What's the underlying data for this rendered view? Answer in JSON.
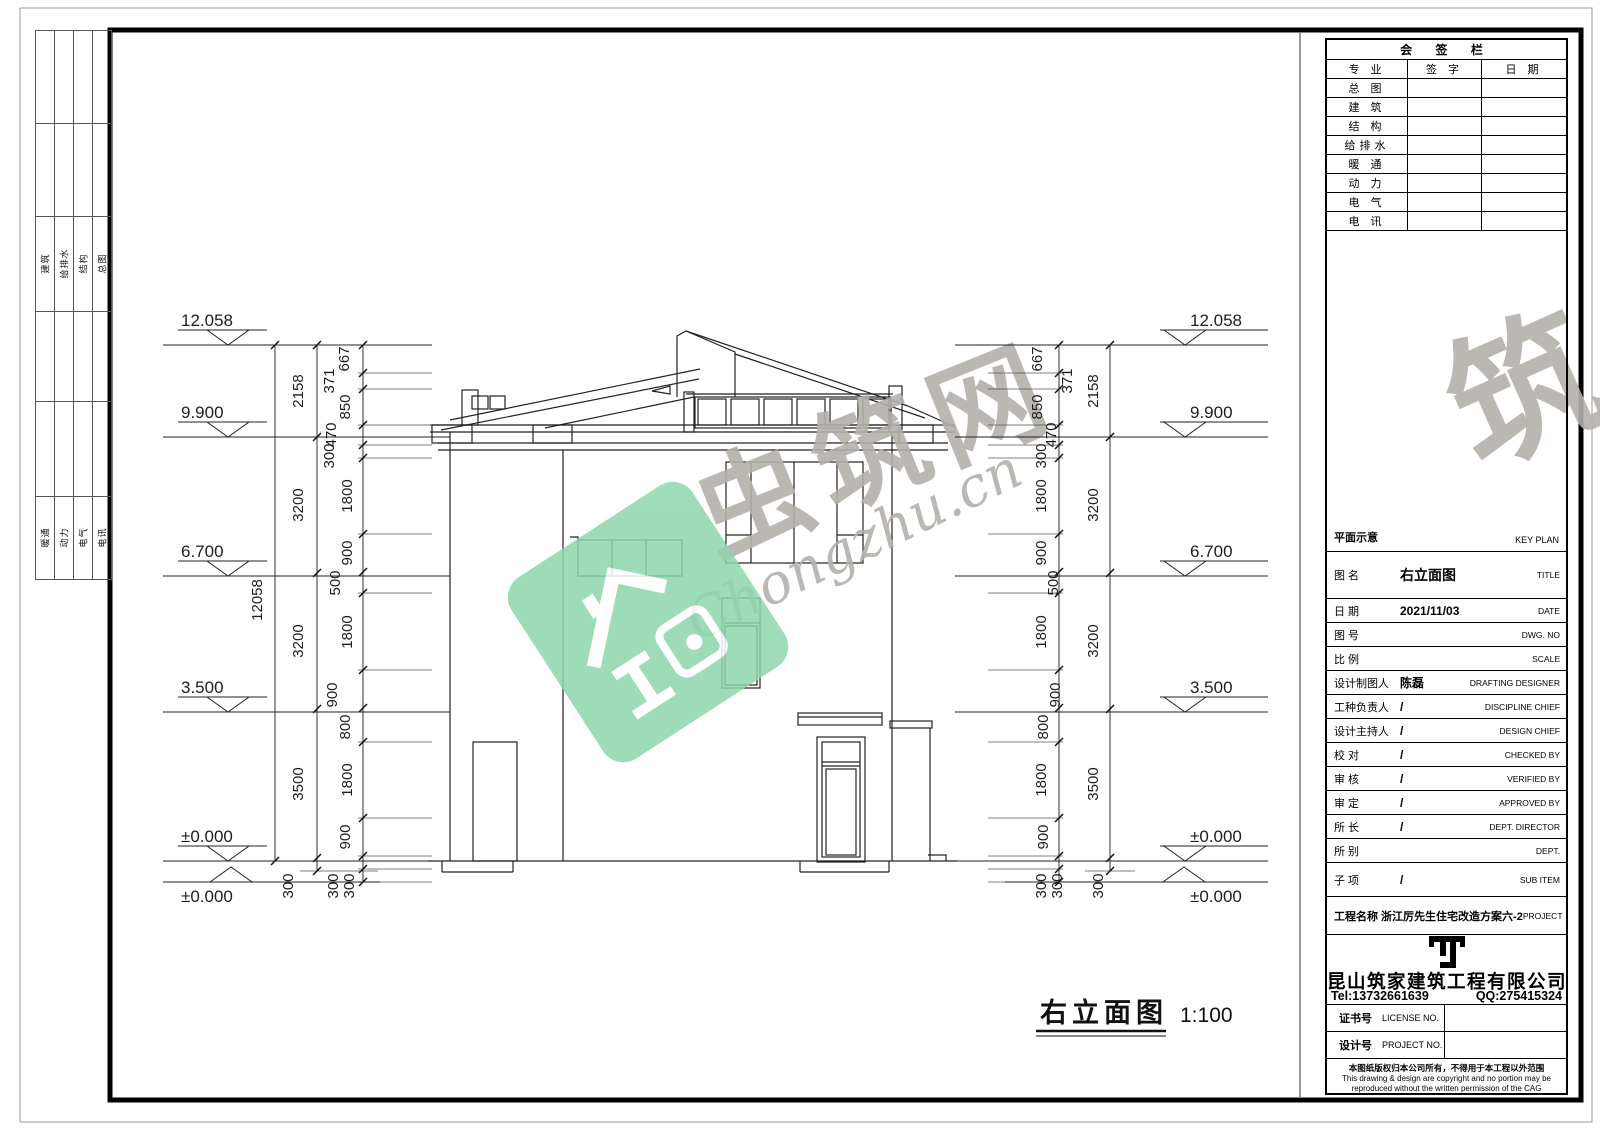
{
  "binding_strip": {
    "row1": [
      "建筑",
      "给排水",
      "结构",
      "总图"
    ],
    "row2": [
      "暖通",
      "动力",
      "电气",
      "电讯"
    ]
  },
  "signature_bar": {
    "title": "会 签 栏",
    "col_headers": [
      "专 业",
      "签 字",
      "日 期"
    ],
    "disciplines": [
      "总 图",
      "建 筑",
      "结 构",
      "给排水",
      "暖 通",
      "动 力",
      "电 气",
      "电 讯"
    ]
  },
  "key_plan": {
    "cn": "平面示意",
    "en": "KEY PLAN"
  },
  "title_block": {
    "rows": [
      {
        "cn": "图 名",
        "value": "右立面图",
        "en": "TITLE"
      },
      {
        "cn": "日 期",
        "value": "2021/11/03",
        "en": "DATE"
      },
      {
        "cn": "图 号",
        "value": "",
        "en": "DWG. NO"
      },
      {
        "cn": "比 例",
        "value": "",
        "en": "SCALE"
      },
      {
        "cn": "设计制图人",
        "value": "陈磊",
        "en": "DRAFTING DESIGNER"
      },
      {
        "cn": "工种负责人",
        "value": "/",
        "en": "DISCIPLINE CHIEF"
      },
      {
        "cn": "设计主持人",
        "value": "/",
        "en": "DESIGN CHIEF"
      },
      {
        "cn": "校 对",
        "value": "/",
        "en": "CHECKED BY"
      },
      {
        "cn": "审 核",
        "value": "/",
        "en": "VERIFIED BY"
      },
      {
        "cn": "审 定",
        "value": "/",
        "en": "APPROVED BY"
      },
      {
        "cn": "所 长",
        "value": "/",
        "en": "DEPT. DIRECTOR"
      },
      {
        "cn": "所 别",
        "value": "",
        "en": "DEPT."
      },
      {
        "cn": "子 项",
        "value": "/",
        "en": "SUB ITEM"
      }
    ],
    "project": {
      "cn": "工程名称 浙江厉先生住宅改造方案六-2",
      "en": "PROJECT"
    }
  },
  "company": {
    "name": "昆山筑家建筑工程有限公司",
    "tel": "Tel:13732661639",
    "qq": "QQ:275415324",
    "license_cn": "证书号",
    "license_en": "LICENSE NO.",
    "project_no_cn": "设计号",
    "project_no_en": "PROJECT NO.",
    "copyright_cn": "本图纸版权归本公司所有，不得用于本工程以外范围",
    "copyright_en1": "This drawing & design are copyright and no portion may be",
    "copyright_en2": "reproduced without the written permission of the CAG"
  },
  "drawing_label": {
    "title": "右立面图",
    "scale": "1:100"
  },
  "watermark": {
    "cn": "虫筑网",
    "en": "Chongzhu.cn",
    "accent_green": "#8ed6ac",
    "gray": "#b4afab"
  },
  "dims": {
    "levels": [
      "12.058",
      "9.900",
      "6.700",
      "3.500",
      "±0.000"
    ],
    "ground": "±0.000",
    "overall": "12058",
    "coarse": [
      "2158",
      "3200",
      "3200",
      "3500"
    ],
    "fine": [
      "667",
      "371",
      "850",
      "470",
      "300",
      "1800",
      "900",
      "500",
      "1800",
      "900",
      "800",
      "1800",
      "900"
    ],
    "below": [
      "300",
      "300",
      "300"
    ]
  }
}
